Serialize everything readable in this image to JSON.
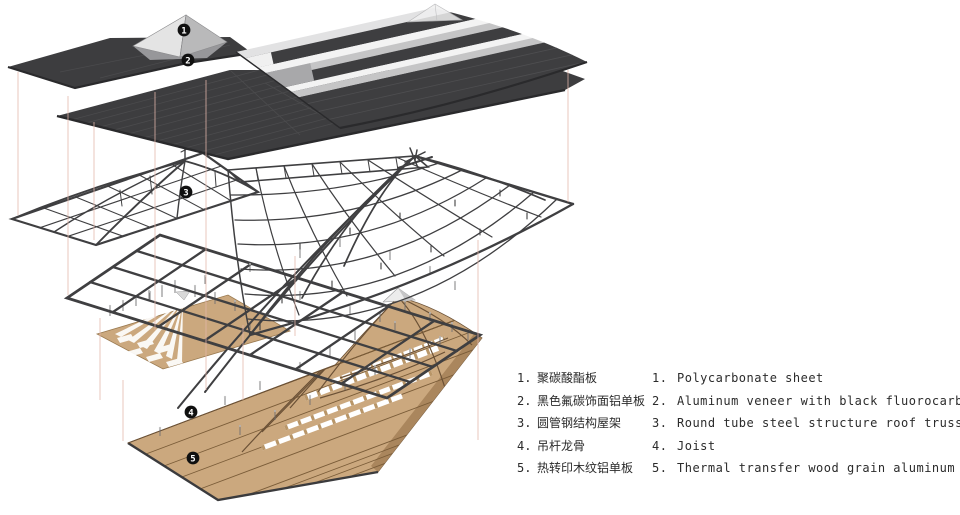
{
  "legend": {
    "items": [
      {
        "zh_num": "1.",
        "zh": "聚碳酸酯板",
        "en_num": "1.",
        "en": "Polycarbonate sheet"
      },
      {
        "zh_num": "2.",
        "zh": "黑色氟碳饰面铝单板",
        "en_num": "2.",
        "en": "Aluminum veneer with black fluorocarbon paint finish"
      },
      {
        "zh_num": "3.",
        "zh": "圆管钢结构屋架",
        "en_num": "3.",
        "en": "Round tube steel structure roof truss"
      },
      {
        "zh_num": "4.",
        "zh": "吊杆龙骨",
        "en_num": "4.",
        "en": "Joist"
      },
      {
        "zh_num": "5.",
        "zh": "热转印木纹铝单板",
        "en_num": "5.",
        "en": "Thermal transfer wood grain aluminum veneer"
      }
    ]
  },
  "markers": [
    "1",
    "2",
    "3",
    "4",
    "5"
  ],
  "colors": {
    "bg": "#ffffff",
    "roof_dark": "#3d3d3f",
    "roof_edge": "#2a2a2c",
    "seam": "#4b4b4d",
    "steel": "#3f3f41",
    "wood": "#cba87e",
    "wood_line": "#7a5c38",
    "wood_shade": "#aa865d",
    "guide": "#e4b6aa",
    "marker_bg": "#101010",
    "marker_fg": "#ffffff",
    "text": "#2b2b2b",
    "stripe_light": "#c5c5c6",
    "stripe_white": "#f3f3f3",
    "pyramid_light": "#e4e4e4"
  }
}
